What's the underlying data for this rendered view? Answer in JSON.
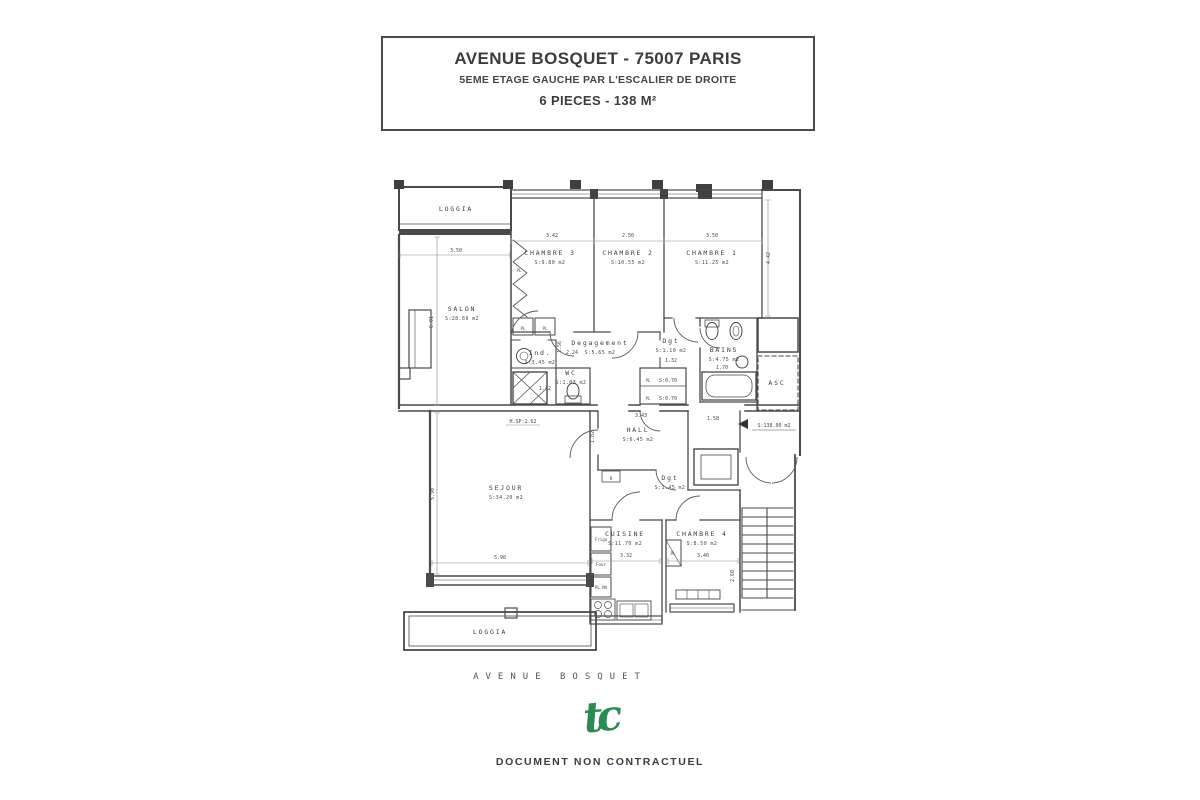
{
  "title_block": {
    "line1": "AVENUE BOSQUET - 75007 PARIS",
    "line2": "5EME ETAGE GAUCHE PAR L'ESCALIER DE DROITE",
    "line3": "6 PIECES - 138 M²"
  },
  "plan": {
    "rooms": [
      {
        "id": "loggia-top",
        "label": "LOGGIA",
        "area": "",
        "x": 456,
        "y": 211
      },
      {
        "id": "salon",
        "label": "SALON",
        "area": "S:28.69 m2",
        "x": 462,
        "y": 311
      },
      {
        "id": "chambre-3",
        "label": "CHAMBRE 3",
        "area": "S:9.80 m2",
        "x": 550,
        "y": 255
      },
      {
        "id": "chambre-2",
        "label": "CHAMBRE 2",
        "area": "S:10.55 m2",
        "x": 628,
        "y": 255
      },
      {
        "id": "chambre-1",
        "label": "CHAMBRE 1",
        "area": "S:11.25 m2",
        "x": 712,
        "y": 255
      },
      {
        "id": "degagement",
        "label": "Degagement",
        "area": "S:5.65 m2",
        "x": 600,
        "y": 345
      },
      {
        "id": "dgt-bains",
        "label": "Dgt",
        "area": "S:1.10 m2",
        "x": 671,
        "y": 343
      },
      {
        "id": "wc",
        "label": "WC",
        "area": "S:1.03 m2",
        "x": 571,
        "y": 375
      },
      {
        "id": "ind",
        "label": "Ind.",
        "area": "S:3.45 m2",
        "x": 540,
        "y": 355
      },
      {
        "id": "bains",
        "label": "BAINS",
        "area": "S:4.75 m2",
        "x": 724,
        "y": 352
      },
      {
        "id": "asc",
        "label": "ASC",
        "area": "",
        "x": 777,
        "y": 385
      },
      {
        "id": "hall",
        "label": "HALL",
        "area": "S:6.45 m2",
        "x": 638,
        "y": 432
      },
      {
        "id": "dgt-entree",
        "label": "Dgt",
        "area": "S:1.45 m2",
        "x": 670,
        "y": 480
      },
      {
        "id": "sejour",
        "label": "SEJOUR",
        "area": "S:34.20 m2",
        "x": 506,
        "y": 490
      },
      {
        "id": "cuisine",
        "label": "CUISINE",
        "area": "S:11.70 m2",
        "x": 625,
        "y": 536
      },
      {
        "id": "chambre-4",
        "label": "CHAMBRE 4",
        "area": "S:8.50 m2",
        "x": 702,
        "y": 536
      },
      {
        "id": "loggia-bottom",
        "label": "LOGGIA",
        "area": "",
        "x": 490,
        "y": 634
      }
    ],
    "dims": [
      {
        "t": "3.50",
        "x": 456,
        "y": 252
      },
      {
        "t": "3.42",
        "x": 552,
        "y": 237
      },
      {
        "t": "2.50",
        "x": 628,
        "y": 237
      },
      {
        "t": "3.50",
        "x": 712,
        "y": 237
      },
      {
        "t": "6.01",
        "x": 433,
        "y": 322,
        "r": -90
      },
      {
        "t": "4.42",
        "x": 770,
        "y": 258,
        "r": -90
      },
      {
        "t": "1.56",
        "x": 561,
        "y": 347,
        "r": -90
      },
      {
        "t": "2.24",
        "x": 572,
        "y": 354
      },
      {
        "t": "1.42",
        "x": 545,
        "y": 390
      },
      {
        "t": "1.32",
        "x": 671,
        "y": 362
      },
      {
        "t": "S:0.70",
        "x": 668,
        "y": 382
      },
      {
        "t": "S:0.70",
        "x": 668,
        "y": 400
      },
      {
        "t": "1.70",
        "x": 722,
        "y": 369
      },
      {
        "t": "3.43",
        "x": 641,
        "y": 417
      },
      {
        "t": "1.58",
        "x": 713,
        "y": 420
      },
      {
        "t": "1.82",
        "x": 594,
        "y": 437,
        "r": -90
      },
      {
        "t": "H.SP:2.62",
        "x": 523,
        "y": 423
      },
      {
        "t": "S:138.00 m2",
        "x": 774,
        "y": 427
      },
      {
        "t": "5.90",
        "x": 500,
        "y": 559
      },
      {
        "t": "5.90",
        "x": 434,
        "y": 494,
        "r": -90
      },
      {
        "t": "3.32",
        "x": 626,
        "y": 557
      },
      {
        "t": "3.40",
        "x": 703,
        "y": 557
      },
      {
        "t": "2.60",
        "x": 734,
        "y": 576,
        "r": -90
      }
    ],
    "misc": [
      {
        "t": "PL",
        "x": 519,
        "y": 272
      },
      {
        "t": "PL",
        "x": 523,
        "y": 330
      },
      {
        "t": "PL",
        "x": 545,
        "y": 330
      },
      {
        "t": "PL",
        "x": 648,
        "y": 382
      },
      {
        "t": "PL",
        "x": 648,
        "y": 400
      },
      {
        "t": "PL",
        "x": 673,
        "y": 555
      },
      {
        "t": "R",
        "x": 611,
        "y": 480
      },
      {
        "t": "Frigo",
        "x": 601,
        "y": 541
      },
      {
        "t": "Four",
        "x": 601,
        "y": 566
      },
      {
        "t": "PL.MA",
        "x": 601,
        "y": 589
      }
    ],
    "street_label": "AVENUE  BOSQUET"
  },
  "footer": {
    "logo_text": "tc",
    "logo_color": "#2c8a57",
    "disclaimer": "DOCUMENT NON CONTRACTUEL"
  }
}
